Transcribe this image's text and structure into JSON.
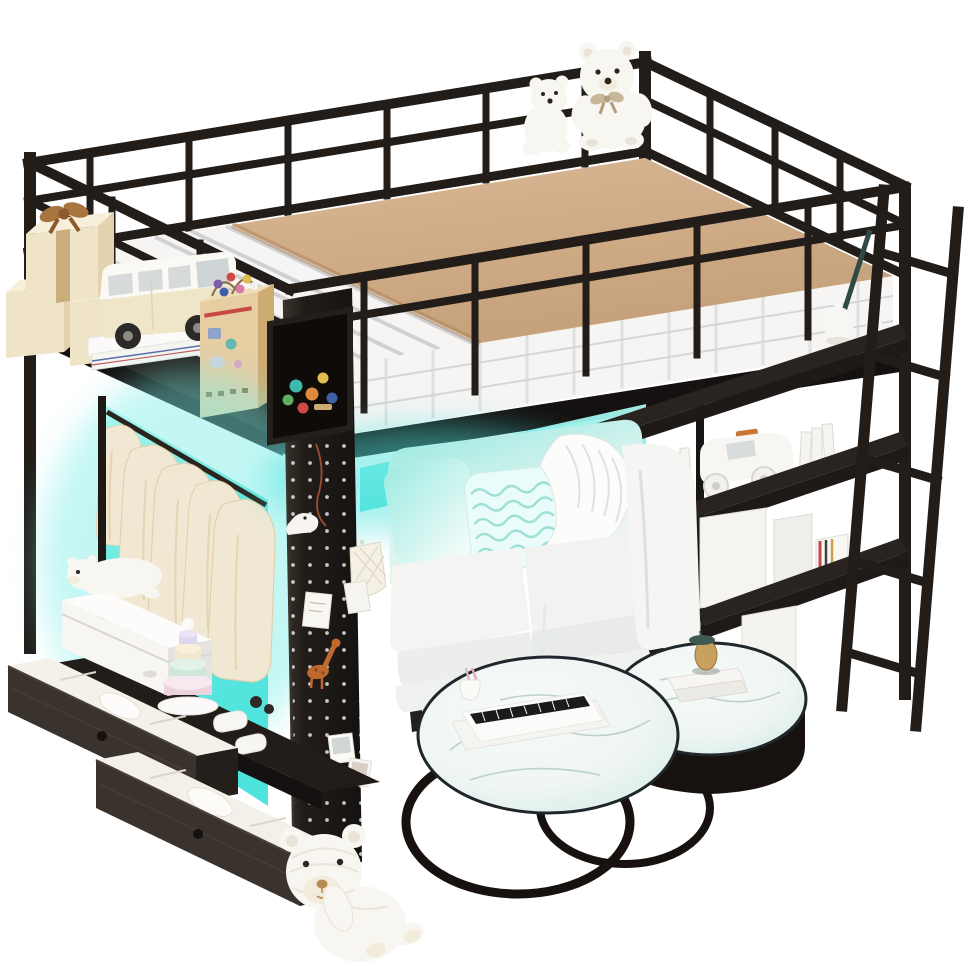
{
  "image": {
    "title": "Black metal loft bed with LED lights, wardrobe, shelves, drawers, sofa and nesting coffee tables underneath",
    "background": "#ffffff"
  },
  "palette": {
    "frame": "#221d19",
    "frame_dark": "#141110",
    "frame_highlight": "#3a332c",
    "brace_teal": "#2f4a45",
    "mattress": "#f6f5f3",
    "mattress_shadow": "#eceeef",
    "mattress_stripe": "#c3c6ca",
    "blanket": "#c5a17a",
    "blanket_light": "#dab895",
    "led": "#4fe3de",
    "led_light": "#aef5ef",
    "wardrobe_glow": "#63e8e0",
    "clothes": "#f1e8d3",
    "clothes_shadow": "#e0cfa8",
    "wood_face": "#e6cda2",
    "wood_side": "#cdab72",
    "wood_top": "#f0ddb8",
    "gift_cream": "#efe3c8",
    "gift_cream_dark": "#e2d2b0",
    "ribbon_tan": "#a8743f",
    "sofa": "#f4f5f2",
    "sofa_shadow": "#dde1de",
    "sofa_tint": "#8fe8df",
    "pillow_mint": "#9debe2",
    "throw_white": "#fcfcfb",
    "marble": "#eef5f2",
    "marble_tint": "#cde9e2",
    "marble_vein": "#a5c0ba",
    "table_rim": "#20262b",
    "table_base": "#17120f",
    "drawer_face": "#39322d",
    "drawer_side": "#241f1b",
    "drawer_top": "#221d19",
    "knob": "#15110e",
    "white_goods": "#f7f6f3",
    "white_goods_shadow": "#e6e3dd",
    "bear": "#f8f6f1",
    "bear_shadow": "#e9e3d8",
    "muzzle_tan": "#f3ecdc",
    "nose_brown": "#b98b54",
    "giraffe": "#c0692f",
    "bead_red": "#cf4a44",
    "bead_blue": "#3f5fa8",
    "bead_yellow": "#e3bc4e",
    "bead_pink": "#d879a8",
    "bead_green": "#5fae62",
    "bead_teal": "#3fb8ae",
    "bead_orange": "#dd8a3c",
    "bead_purple": "#7a5ea8",
    "car_accent": "#c87636",
    "brass": "#c9a15e",
    "brass_dark": "#9a7434",
    "lamp_cap": "#3e5a52",
    "pink_stick": "#e8a8b8"
  },
  "objects": {
    "loft_bed_frame": "black metal loft bed with guardrails",
    "mattress": "white quilted mattress with grey striped sheet",
    "blanket": "tan blanket on top of mattress",
    "teddy_bears": "two white teddy bears sitting on the bed",
    "gift_boxes": "cream gift boxes with tan ribbon bow",
    "toy_van": "cream toy camper van on white books",
    "busy_board": "wooden activity cube with colourful beads",
    "toy_cubby": "black cubby holding colourful bead toys",
    "wardrobe": "open wardrobe with cyan LED backlight and hanging cream clothes",
    "pegboard": "black pegboard pillar with hanging keepsakes",
    "giraffe_toy": "orange giraffe figurine on pegboard",
    "led_strip": "cyan LED under-bed lighting",
    "sofa": "white loveseat with mint pillows and white throw",
    "bookshelf": "black three-tier shelf with white books, toy car and boxes",
    "teapot": "white teapot on top shelf",
    "ladder": "black metal access ladder",
    "drawers": "two dark wood pull-out drawers with folded white clothes",
    "storage_box": "white storage box with plush polar bear on top",
    "stacking_toy": "pastel stacking ring tower",
    "baby_shoes": "white baby shoes",
    "coffee_tables": "two nesting round marble-top coffee tables with black bases",
    "toy_piano": "white toy piano on the large table",
    "table_ornament": "small brass ornament on the small table",
    "knitted_bear": "white knitted teddy bear sitting on the floor"
  }
}
